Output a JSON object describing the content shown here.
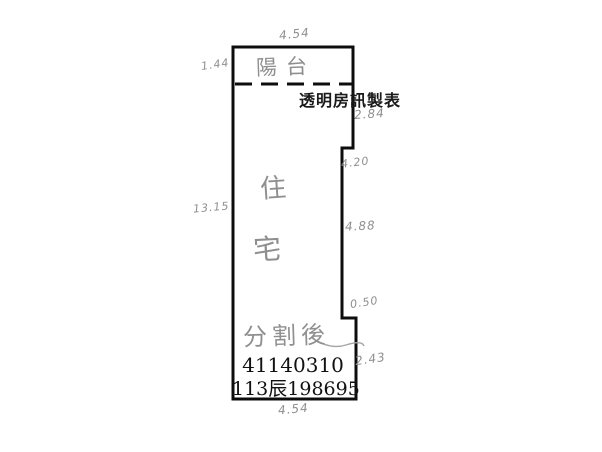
{
  "document": {
    "type_note": "scanned cadastral floor-plan sketch",
    "watermark": "透明房訊製表",
    "parcel_number": "41140310",
    "case_number": "113辰198695"
  },
  "plan": {
    "balcony_label": "陽台",
    "room_label_chars": [
      "住",
      "宅"
    ],
    "division_note": "分割後",
    "measurements": {
      "top": "4.54",
      "left_upper": "1.44",
      "left_middle": "13.15",
      "right_upper": "2.84",
      "right_step": "4.20",
      "right_middle": "4.88",
      "right_notch": "0.50",
      "right_lower": "2.43",
      "bottom": "4.54"
    }
  },
  "colors": {
    "ink": "#111111",
    "pencil": "#8f8f8f",
    "background": "#ffffff"
  }
}
